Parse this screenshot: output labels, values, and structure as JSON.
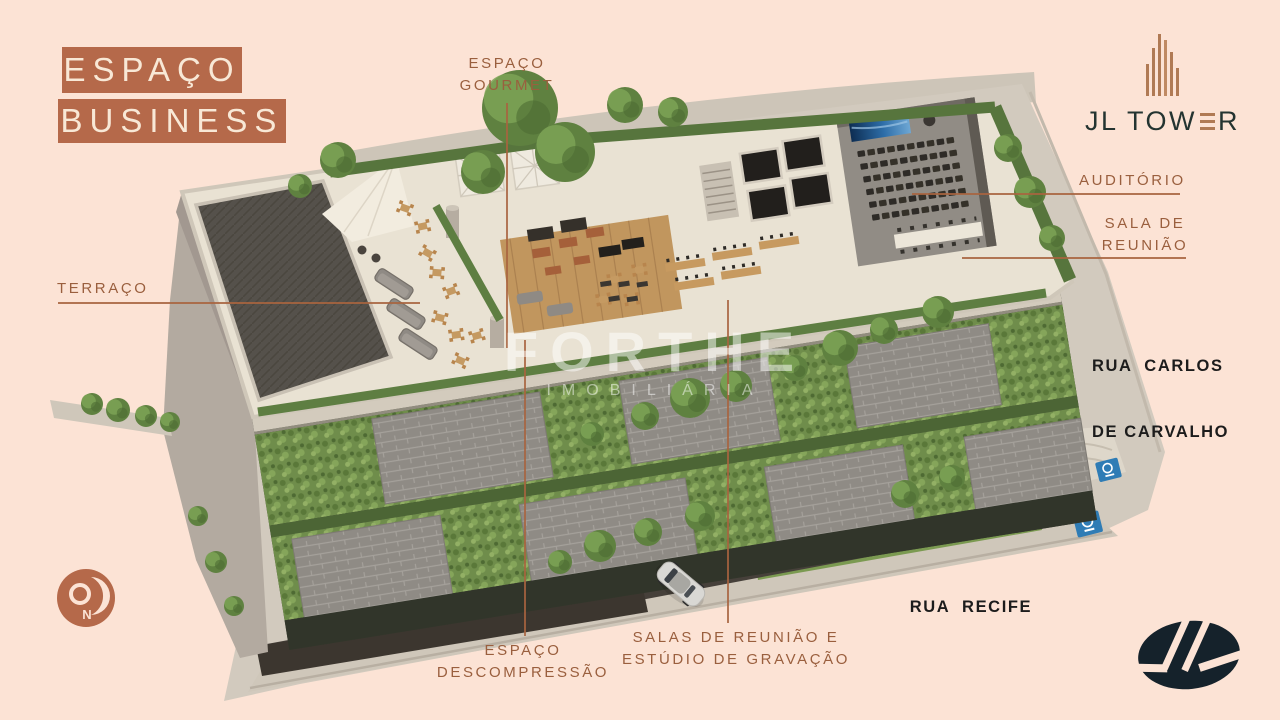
{
  "colors": {
    "background": "#fce3d5",
    "accent_terracotta": "#b5694a",
    "callout_text": "#9a5f3e",
    "leader_line": "#a8643f",
    "street_text": "#1c1c1c",
    "brand_dark": "#243431",
    "brand_copper": "#b07a54",
    "logo_navy": "#15222b"
  },
  "title": {
    "line1": "ESPAÇO",
    "line2": "BUSINESS"
  },
  "brand": {
    "name": "JL TOWER",
    "name_prefix": "JL TOW",
    "name_suffix": "R"
  },
  "callouts": {
    "gourmet": {
      "line1": "ESPAÇO",
      "line2": "GOURMET"
    },
    "terraco": {
      "label": "TERRAÇO"
    },
    "auditorio": {
      "label": "AUDITÓRIO"
    },
    "sala_reuniao": {
      "line1": "SALA DE",
      "line2": "REUNIÃO"
    },
    "descompressao": {
      "line1": "ESPAÇO",
      "line2": "DESCOMPRESSÃO"
    },
    "salas_estudio": {
      "line1": "SALAS DE REUNIÃO E",
      "line2": "ESTÚDIO DE GRAVAÇÃO"
    }
  },
  "streets": {
    "carlos": {
      "line1": "RUA  CARLOS",
      "line2": "DE CARVALHO"
    },
    "recife": {
      "label": "RUA  RECIFE"
    }
  },
  "watermark": {
    "line1": "FORTHE",
    "line2": "IMOBILIÁRIA"
  },
  "compass": {
    "north": "N"
  }
}
